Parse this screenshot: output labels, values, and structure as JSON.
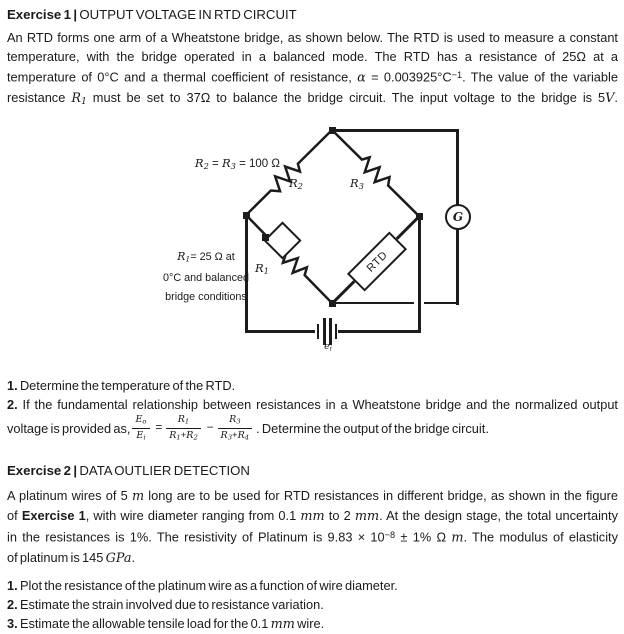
{
  "exercise1": {
    "heading": [
      {
        "t": "Exercise 1 | ",
        "s": "b"
      },
      {
        "t": "OUTPUT VOLTAGE IN RTD CIRCUIT",
        "s": ""
      }
    ],
    "para_lines": [
      [
        {
          "t": "An RTD forms one arm of a Wheatstone bridge, as shown below. The RTD is used to measure a constant",
          "s": ""
        }
      ],
      [
        {
          "t": "temperature, with the bridge operated in a balanced mode. The RTD has a resistance of 25Ω at a",
          "s": ""
        }
      ],
      [
        {
          "t": "temperature of 0°C and a thermal coefficient of resistance, ",
          "s": ""
        },
        {
          "t": "α",
          "s": "i"
        },
        {
          "t": " = 0.003925°C",
          "s": ""
        },
        {
          "t": "−1",
          "s": "sup"
        },
        {
          "t": ". The value of the variable",
          "s": ""
        }
      ],
      [
        {
          "t": "resistance ",
          "s": ""
        },
        {
          "t": "R",
          "s": "i"
        },
        {
          "t": "1",
          "s": "isub"
        },
        {
          "t": " must be set to 37Ω to balance the bridge circuit. The input voltage to the bridge is 5",
          "s": ""
        },
        {
          "t": "V",
          "s": "i"
        },
        {
          "t": ".",
          "s": ""
        }
      ]
    ],
    "item1": [
      {
        "t": "1.",
        "s": "b"
      },
      {
        "t": " Determine the temperature of the RTD.",
        "s": ""
      }
    ],
    "item2_line1": [
      {
        "t": "2.",
        "s": "b"
      },
      {
        "t": " If the fundamental relationship between resistances in a Wheatstone bridge and the normalized output",
        "s": ""
      }
    ],
    "item2_line2_prefix": [
      {
        "t": "voltage is provided as,",
        "s": ""
      }
    ],
    "formula": {
      "lhs_num": [
        {
          "t": "E",
          "s": "i"
        },
        {
          "t": "o",
          "s": "isub"
        }
      ],
      "lhs_den": [
        {
          "t": "E",
          "s": "i"
        },
        {
          "t": "i",
          "s": "isub"
        }
      ],
      "eq": "=",
      "f1_num": [
        {
          "t": "R",
          "s": "i"
        },
        {
          "t": "1",
          "s": "isub"
        }
      ],
      "f1_den": [
        {
          "t": "R",
          "s": "i"
        },
        {
          "t": "1",
          "s": "isub"
        },
        {
          "t": "+",
          "s": ""
        },
        {
          "t": "R",
          "s": "i"
        },
        {
          "t": "2",
          "s": "isub"
        }
      ],
      "minus": "−",
      "f2_num": [
        {
          "t": "R",
          "s": "i"
        },
        {
          "t": "3",
          "s": "isub"
        }
      ],
      "f2_den": [
        {
          "t": "R",
          "s": "i"
        },
        {
          "t": "3",
          "s": "isub"
        },
        {
          "t": "+",
          "s": ""
        },
        {
          "t": "R",
          "s": "i"
        },
        {
          "t": "4",
          "s": "isub"
        }
      ]
    },
    "item2_line2_suffix": [
      {
        "t": ". Determine the output of the bridge circuit.",
        "s": ""
      }
    ]
  },
  "diagram": {
    "label_r2r3": [
      {
        "t": "R",
        "s": "i"
      },
      {
        "t": "2",
        "s": "isub"
      },
      {
        "t": " = ",
        "s": ""
      },
      {
        "t": "R",
        "s": "i"
      },
      {
        "t": "3",
        "s": "isub"
      },
      {
        "t": " = 100 Ω",
        "s": ""
      }
    ],
    "label_r2": [
      {
        "t": "R",
        "s": "i"
      },
      {
        "t": "2",
        "s": "isub"
      }
    ],
    "label_r3": [
      {
        "t": "R",
        "s": "i"
      },
      {
        "t": "3",
        "s": "isub"
      }
    ],
    "label_r1": [
      {
        "t": "R",
        "s": "i"
      },
      {
        "t": "1",
        "s": "isub"
      }
    ],
    "note_lines": [
      [
        {
          "t": "R",
          "s": "i"
        },
        {
          "t": "1",
          "s": "isub"
        },
        {
          "t": "= 25 Ω at",
          "s": ""
        }
      ],
      [
        {
          "t": "0°C and balanced",
          "s": ""
        }
      ],
      [
        {
          "t": "bridge conditions",
          "s": ""
        }
      ]
    ],
    "rtd_label": "RTD",
    "galvanometer_label": "G",
    "battery_label": [
      {
        "t": "e",
        "s": "i"
      },
      {
        "t": "i",
        "s": "isub"
      }
    ]
  },
  "exercise2": {
    "heading": [
      {
        "t": "Exercise 2 | ",
        "s": "b"
      },
      {
        "t": "DATA OUTLIER DETECTION",
        "s": ""
      }
    ],
    "para_lines": [
      [
        {
          "t": "A platinum wires of 5 ",
          "s": ""
        },
        {
          "t": "m",
          "s": "i"
        },
        {
          "t": " long are to be used for RTD resistances in different bridge, as shown in the figure",
          "s": ""
        }
      ],
      [
        {
          "t": "of ",
          "s": ""
        },
        {
          "t": "Exercise 1",
          "s": "b"
        },
        {
          "t": ", with wire diameter ranging from 0.1 ",
          "s": ""
        },
        {
          "t": "mm",
          "s": "i"
        },
        {
          "t": " to 2 ",
          "s": ""
        },
        {
          "t": "mm",
          "s": "i"
        },
        {
          "t": ". At the design stage, the total uncertainty",
          "s": ""
        }
      ],
      [
        {
          "t": "in the resistances is 1%. The resistivity of Platinum is 9.83 × 10",
          "s": ""
        },
        {
          "t": "−8",
          "s": "sup"
        },
        {
          "t": " ± 1% Ω ",
          "s": ""
        },
        {
          "t": "m",
          "s": "i"
        },
        {
          "t": ". The modulus of elasticity",
          "s": ""
        }
      ],
      [
        {
          "t": "of platinum is 145 ",
          "s": ""
        },
        {
          "t": "GPa",
          "s": "i"
        },
        {
          "t": ".",
          "s": ""
        }
      ]
    ],
    "items": [
      [
        {
          "t": "1.",
          "s": "b"
        },
        {
          "t": " Plot the resistance of the platinum wire as a function of wire diameter.",
          "s": ""
        }
      ],
      [
        {
          "t": "2.",
          "s": "b"
        },
        {
          "t": " Estimate the strain involved due to resistance variation.",
          "s": ""
        }
      ],
      [
        {
          "t": "3.",
          "s": "b"
        },
        {
          "t": " Estimate the allowable tensile load for the 0.1 ",
          "s": ""
        },
        {
          "t": "mm",
          "s": "i"
        },
        {
          "t": " wire.",
          "s": ""
        }
      ]
    ]
  }
}
